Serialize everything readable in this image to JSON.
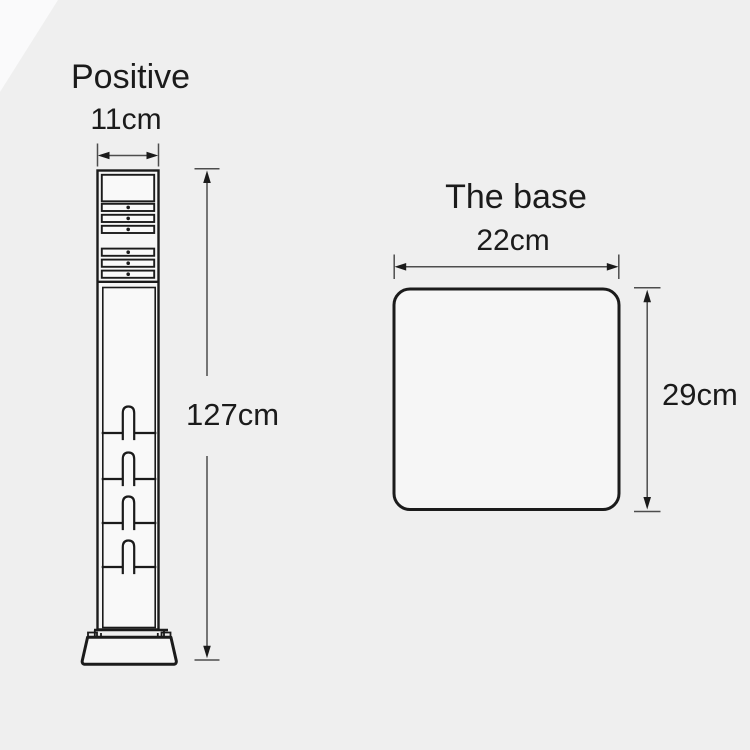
{
  "page": {
    "background": "#efefef"
  },
  "colors": {
    "ink": "#1b1b1b",
    "dim_line": "#4d4d4d",
    "fill": "#f6f6f6",
    "panel_fill": "#f9f9f9",
    "bg": "#efefef"
  },
  "post_figure": {
    "title": "Positive",
    "width_label": "11cm",
    "height_label": "127cm"
  },
  "base_figure": {
    "title": "The base",
    "width_label": "22cm",
    "height_label": "29cm"
  }
}
